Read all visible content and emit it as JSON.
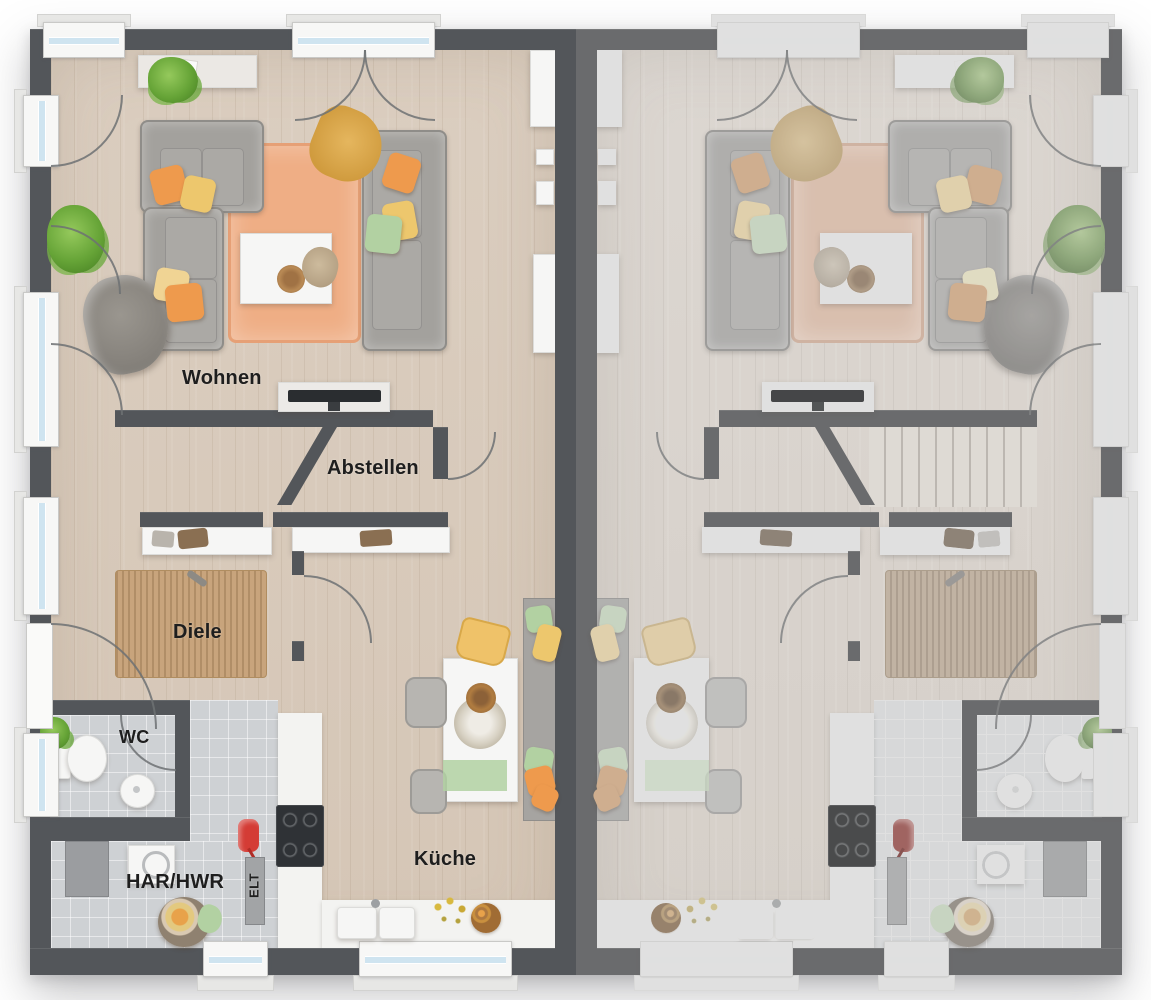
{
  "floorplan": {
    "labels": {
      "living": "Wohnen",
      "storage": "Abstellen",
      "hallway": "Diele",
      "wc": "WC",
      "utility": "HAR/HWR",
      "electrical": "ELT",
      "kitchen": "Küche"
    },
    "colors": {
      "wall_dark": "#53565a",
      "wall_light": "#989da1",
      "floor_wood": "#d8cbbc",
      "floor_tile": "#ced1d4",
      "rug_orange": "#efae85",
      "rug_jute": "#c8a47c",
      "counter": "#f3f3f1",
      "accent_orange": "#ee9a4d",
      "accent_yellow": "#edc76d",
      "accent_pale_yellow": "#f0d494",
      "accent_green": "#b2d1a2",
      "accent_mustard": "#d9a64b",
      "accent_red": "#d43c35",
      "glass": "#cfe4f0",
      "label_text": "#1e1e1e"
    }
  }
}
